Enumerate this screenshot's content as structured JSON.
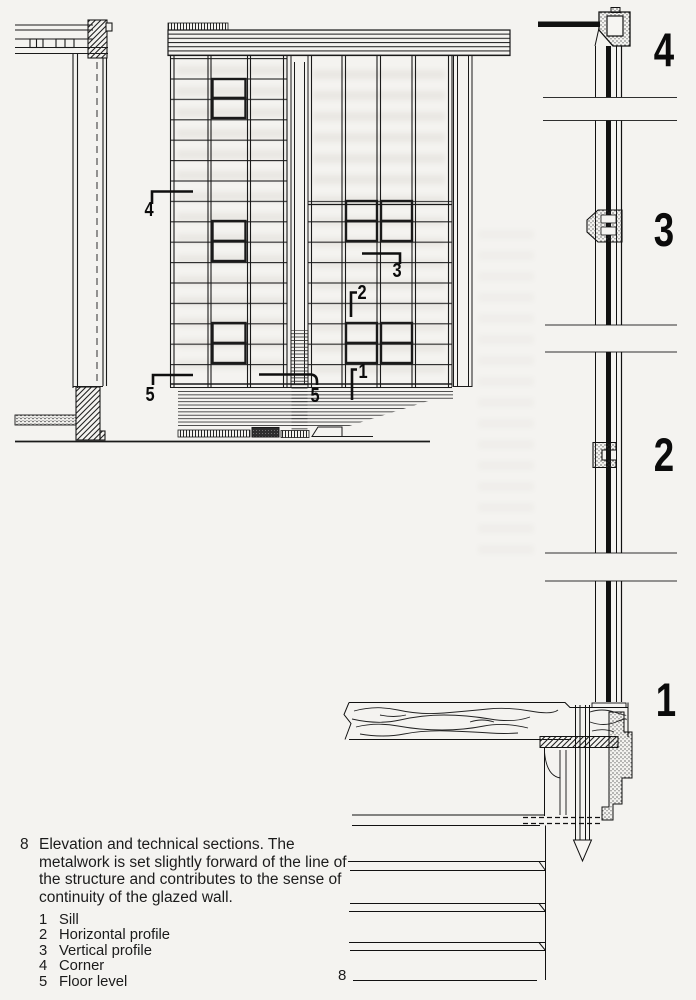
{
  "page": {
    "paper_color": "#f4f3f0",
    "ink_color": "#1a1a1a"
  },
  "figure": {
    "number": "8",
    "caption": "Elevation and technical sections. The metalwork is set slightly forward of the line of the structure and contributes to the sense of continuity of the glazed wall.",
    "legend": [
      {
        "num": "1",
        "label": "Sill"
      },
      {
        "num": "2",
        "label": "Horizontal profile"
      },
      {
        "num": "3",
        "label": "Vertical profile"
      },
      {
        "num": "4",
        "label": "Corner"
      },
      {
        "num": "5",
        "label": "Floor level"
      }
    ]
  },
  "elevation_callouts": {
    "c1": "1",
    "c2": "2",
    "c3": "3",
    "c4": "4",
    "c5_left": "5",
    "c5_mid": "5"
  },
  "section_labels": {
    "corner": "4",
    "vertical_profile": "3",
    "horizontal_profile": "2",
    "sill": "1"
  },
  "page_number": "8"
}
